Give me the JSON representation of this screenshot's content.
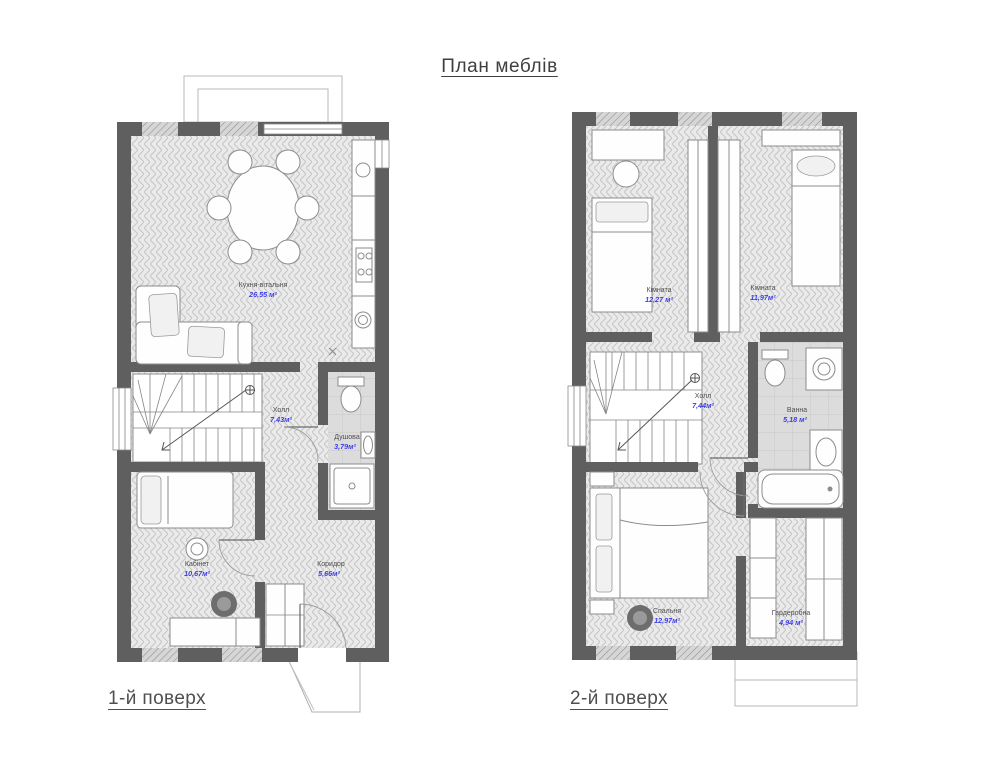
{
  "page": {
    "title": "План меблів"
  },
  "floors": [
    {
      "label": "1-й поверх",
      "rooms": [
        {
          "name": "Кухня-вітальня",
          "area": "26,55 м²"
        },
        {
          "name": "Холл",
          "area": "7,43м²"
        },
        {
          "name": "Душова",
          "area": "3,79м²"
        },
        {
          "name": "Кабінет",
          "area": "10,67м²"
        },
        {
          "name": "Коридор",
          "area": "5,66м²"
        }
      ]
    },
    {
      "label": "2-й поверх",
      "rooms": [
        {
          "name": "Кімната",
          "area": "12,27 м²"
        },
        {
          "name": "Кімната",
          "area": "11,97м²"
        },
        {
          "name": "Холл",
          "area": "7,44м²"
        },
        {
          "name": "Ванна",
          "area": "5,18 м²"
        },
        {
          "name": "Спальня",
          "area": "12,97м²"
        },
        {
          "name": "Гардеробна",
          "area": "4,94 м²"
        }
      ]
    }
  ],
  "colors": {
    "wall": "#5f5f5f",
    "room_name_text": "#4f4f4f",
    "area_value_text": "#3d3de8",
    "floor_label_text": "#4f4f4f"
  }
}
